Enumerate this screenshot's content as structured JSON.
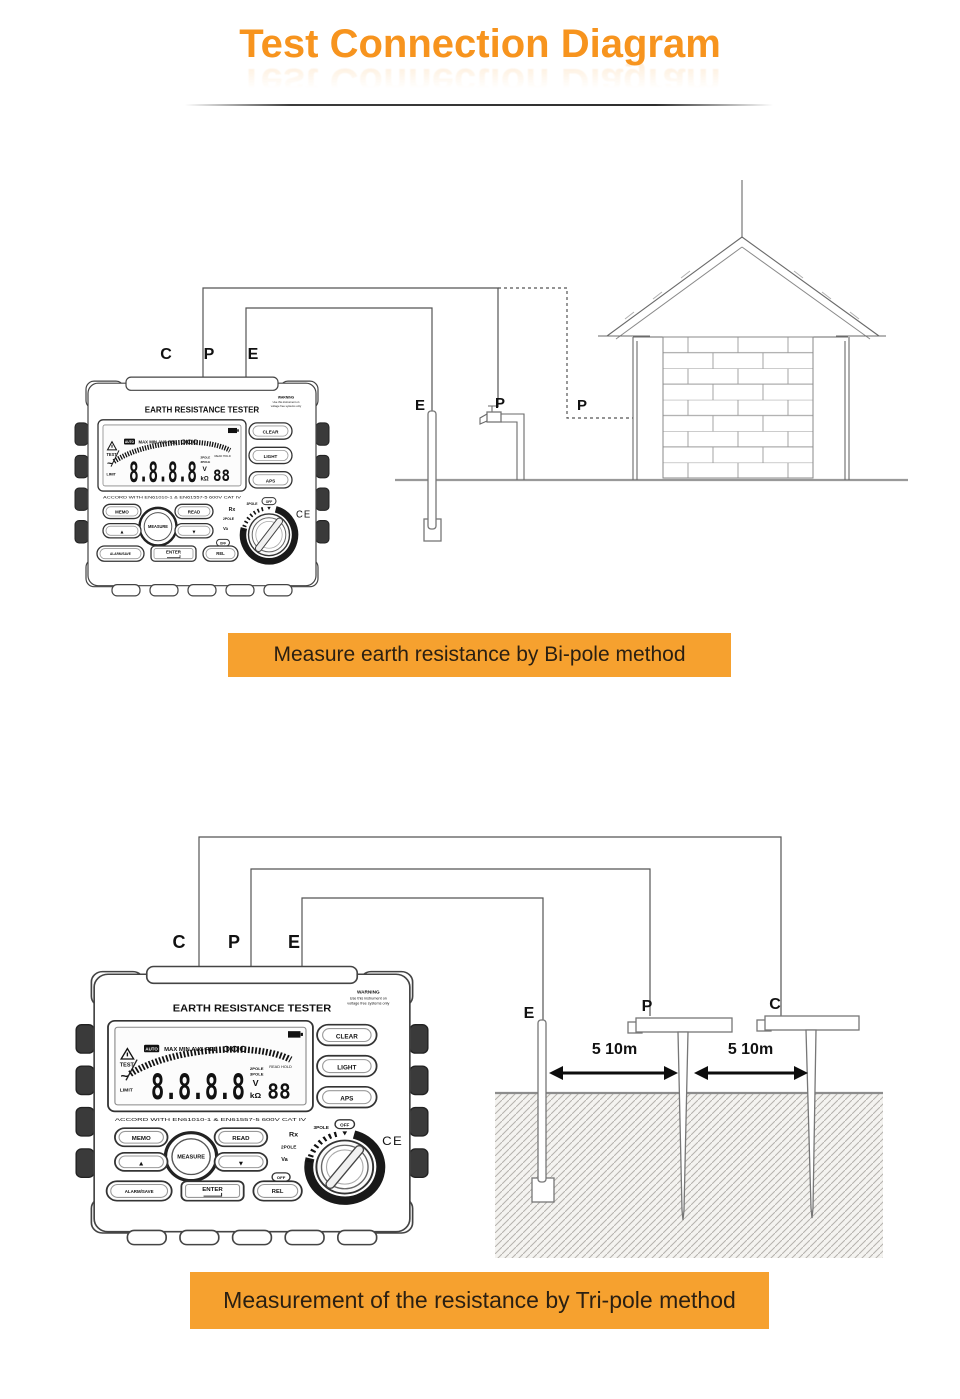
{
  "page": {
    "title": "Test Connection Diagram"
  },
  "bipole": {
    "banner": "Measure earth resistance by Bi-pole method",
    "terminal_c": "C",
    "terminal_p": "P",
    "terminal_e": "E",
    "probe_e": "E",
    "probe_p_tap": "P",
    "probe_p_house": "P"
  },
  "tripole": {
    "banner": "Measurement of the resistance by Tri-pole method",
    "terminal_c": "C",
    "terminal_p": "P",
    "terminal_e": "E",
    "stake_e": "E",
    "stake_p": "P",
    "stake_c": "C",
    "distance_ep": "5 10m",
    "distance_pc": "5 10m"
  },
  "tester": {
    "title": "EARTH RESISTANCE TESTER",
    "warning_line1": "WARNING",
    "warning_line2": "Use this instrument on",
    "warning_line3": "voltage free systems only",
    "display": {
      "auto": "AUTO",
      "flags": "MAX MIN AVG REL",
      "test": "TEST",
      "wave": "~",
      "limit": "LIMIT",
      "digits": "8.8.8.8",
      "pole2": "2POLE",
      "pole3": "3POLE",
      "unit_v": "V",
      "unit_kohm": "kΩ",
      "read": "READ",
      "hold": "HOLD",
      "small_digits": "88",
      "compliance": "ACCORD WITH EN61010-1 & EN61557-5 600V CAT IV"
    },
    "buttons": {
      "clear": "CLEAR",
      "light": "LIGHT",
      "aps": "APS",
      "memo": "MEMO",
      "read": "READ",
      "measure": "MEASURE",
      "up": "▲",
      "down": "▼",
      "alarm_save": "ALARM/SAVE",
      "enter": "ENTER",
      "rel": "REL"
    },
    "dial": {
      "rx": "Rx",
      "pole3": "3POLE",
      "pole2": "2POLE",
      "va": "Va",
      "off_top": "OFF",
      "off_left": "OFF"
    },
    "ce_mark": "CE"
  },
  "colors": {
    "accent_orange": "#F6A12F",
    "title_orange": "#F7941E"
  }
}
